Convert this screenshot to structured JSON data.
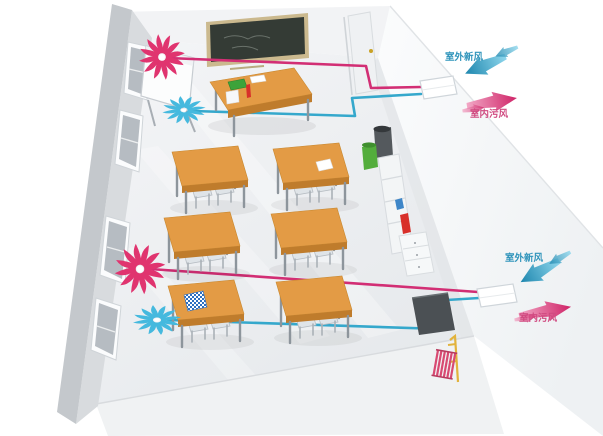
{
  "diagram": {
    "kind": "classroom-fresh-air-ventilation-system",
    "units": [
      {
        "id": "top-unit",
        "fresh_label": "室外新风",
        "exhaust_label": "室内污风"
      },
      {
        "id": "bottom-unit",
        "fresh_label": "室外新风",
        "exhaust_label": "室内污风"
      }
    ],
    "scene": {
      "student_desk_count": 6,
      "exhaust_fan_count": 2,
      "fresh_air_fan_count": 2,
      "erv_unit_count": 2,
      "window_count": 4
    }
  },
  "colors": {
    "fresh_air": "#45b9de",
    "fresh_air_light": "#8ed6ec",
    "fresh_air_deep": "#1d86ae",
    "fresh_text": "#2f94bb",
    "exhaust_air": "#e0346f",
    "exhaust_air_light": "#f2a8c6",
    "exhaust_air_deep": "#cf2367",
    "exhaust_text": "#d04a80",
    "duct_fresh": "#35a8cc",
    "duct_exhaust": "#d22e74",
    "desk_top": "#e39b45",
    "desk_side": "#bf7c2c",
    "desk_leg": "#8d959c",
    "board_face": "#343b35",
    "board_frame": "#cbb98e",
    "bin_green": "#53ad3c",
    "accent_red": "#d8302a",
    "accent_blue": "#3e86c8",
    "radiator_pink": "#d84a72",
    "pipe_yellow": "#e2b33c",
    "checker_blue": "#2e6fc0"
  }
}
